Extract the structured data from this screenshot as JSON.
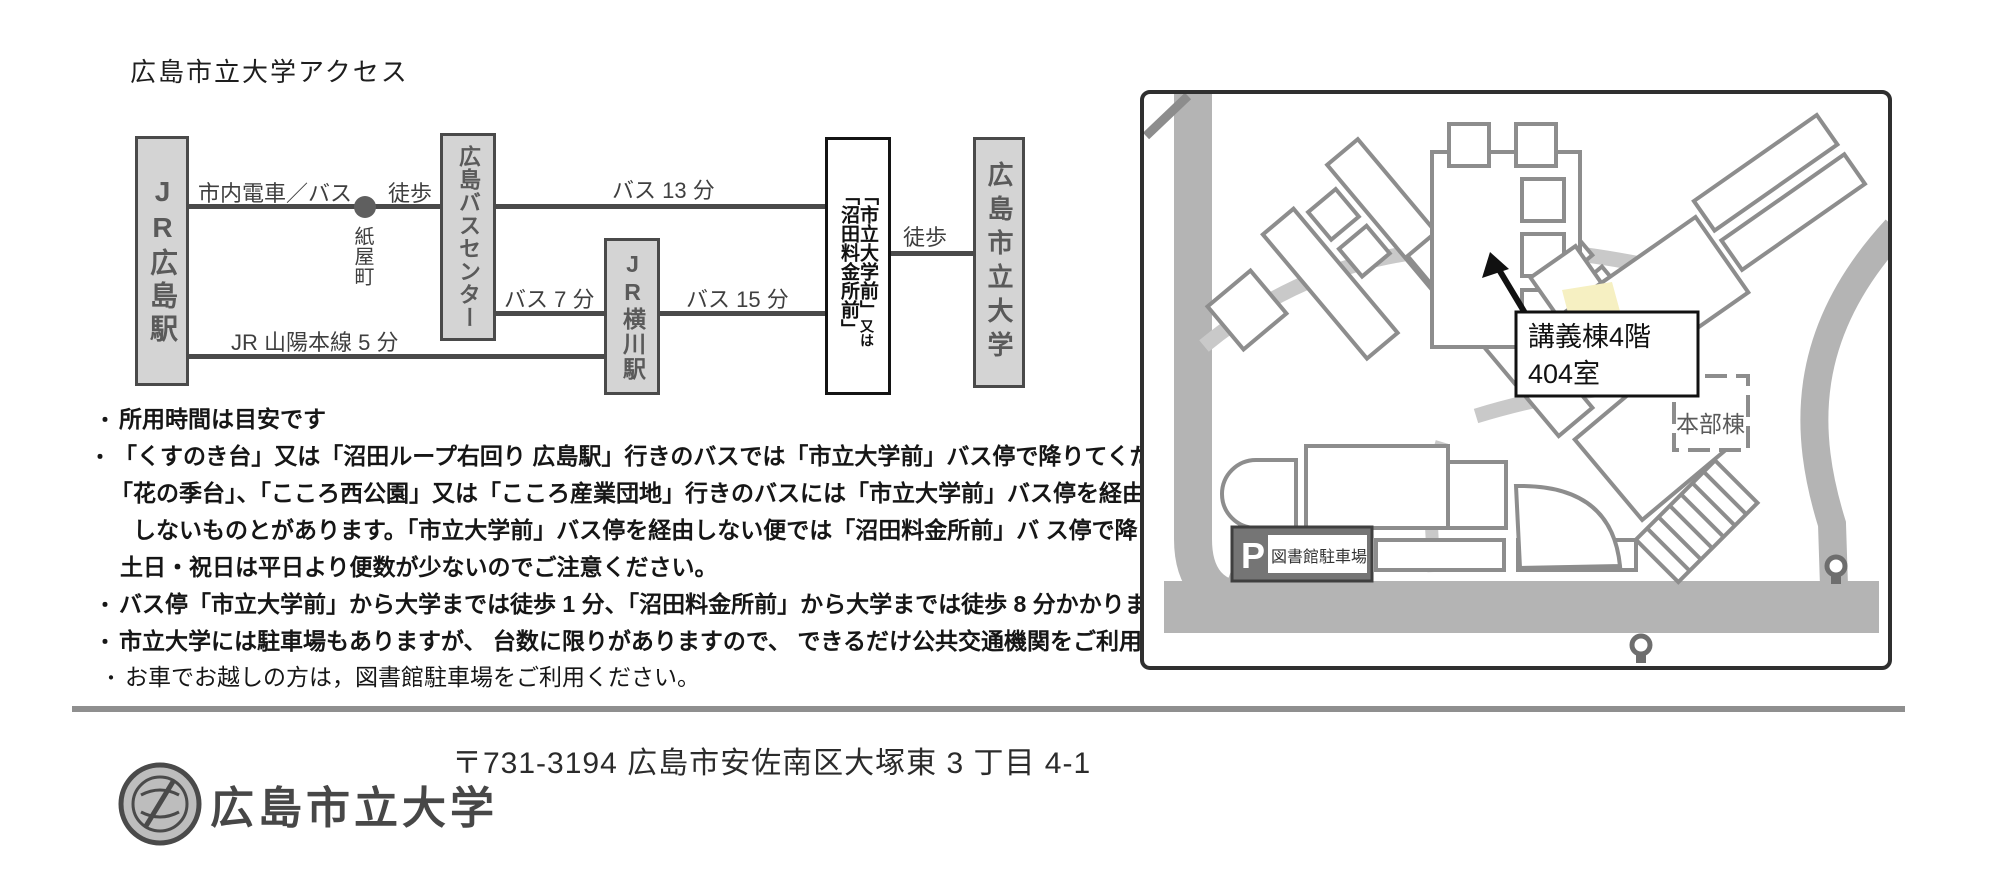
{
  "page": {
    "title": "広島市立大学アクセス"
  },
  "diagram": {
    "nodes": {
      "jr_hiroshima": {
        "label": "JR広島駅"
      },
      "bus_center": {
        "label": "広島バスセンター"
      },
      "jr_yokogawa": {
        "label": "JR横川駅"
      },
      "bus_stop": {
        "primary": "「市立大学前」",
        "conj": "又は",
        "secondary": "「沼田料金所前」"
      },
      "university": {
        "label": "広島市立大学"
      }
    },
    "edges": {
      "tram": "市内電車／バス",
      "walk1": "徒歩",
      "kamiyacho": "紙屋町",
      "bus13": "バス 13 分",
      "bus7": "バス 7 分",
      "bus15": "バス 15 分",
      "walk2": "徒歩",
      "jr_line": "JR 山陽本線 5 分"
    }
  },
  "notes": [
    {
      "bullet": "・",
      "text": "所用時間は目安です"
    },
    {
      "bullet": "・",
      "text": "「くすのき台」又は「沼田ループ右回り 広島駅」行きのバスでは「市立大学前」バス停で降りてください。"
    },
    {
      "bullet": "",
      "text": "「花の季台」、「こころ西公園」又は「こころ産業団地」行きのバスには「市立大学前」バス停を経由すると"
    },
    {
      "bullet": "",
      "text": "しないものとがあります。「市立大学前」バス停を経由しない便では「沼田料金所前」バ ス停で降りて下さい。"
    },
    {
      "bullet": "",
      "text": "土日・祝日は平日より便数が少ないのでご注意ください。"
    },
    {
      "bullet": "・",
      "text": "バス停「市立大学前」から大学までは徒歩 1 分、「沼田料金所前」から大学までは徒歩 8 分かかります。"
    },
    {
      "bullet": "・",
      "text": "市立大学には駐車場もありますが、 台数に限りがありますので、 できるだけ公共交通機関をご利用ください。"
    },
    {
      "bullet": "・",
      "text": "お車でお越しの方は，図書館駐車場をご利用ください。"
    }
  ],
  "map": {
    "annotation": {
      "line1": "講義棟4階",
      "line2": "404室"
    },
    "honbu": "本部棟",
    "parking_p": "P",
    "parking_label": "図書館駐車場"
  },
  "footer": {
    "name": "広島市立大学",
    "address": "〒731-3194 広島市安佐南区大塚東 3 丁目 4-1"
  },
  "colors": {
    "node_fill": "#d4d4d4",
    "node_border": "#4a4a4a",
    "edge": "#4a4a4a",
    "road": "#b4b4b4",
    "path": "#c9c9c9",
    "building_stroke": "#8d8d8d",
    "highlight": "#f6f0c2",
    "badge": "#757575"
  }
}
